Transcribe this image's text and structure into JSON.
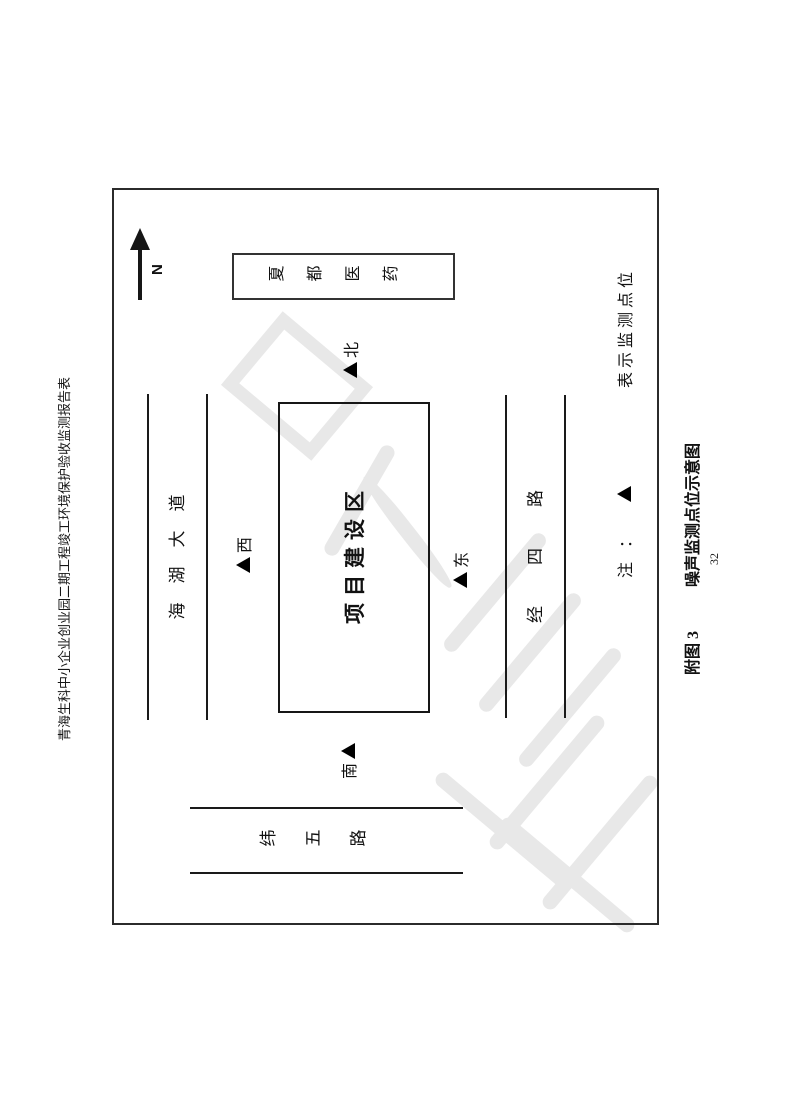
{
  "page": {
    "number": "32"
  },
  "header": {
    "title": "青海生科中小企业创业园二期工程竣工环境保护验收监测报告表"
  },
  "diagram": {
    "north_label": "N",
    "building": {
      "name": "夏都医药"
    },
    "site": {
      "name": "项目建设区"
    },
    "roads": {
      "haihu": "海湖大道",
      "jingsi": "经四路",
      "weiwu": "纬五路"
    },
    "points": {
      "north": "北",
      "west": "西",
      "east": "东",
      "south": "南"
    },
    "note": {
      "prefix": "注：",
      "text": "表示监测点位"
    }
  },
  "caption": {
    "prefix": "附图 3",
    "title": "噪声监测点位示意图"
  },
  "colors": {
    "line": "#1a1a1a",
    "text": "#111111",
    "watermark": "#e8e8e8",
    "background": "#ffffff"
  }
}
